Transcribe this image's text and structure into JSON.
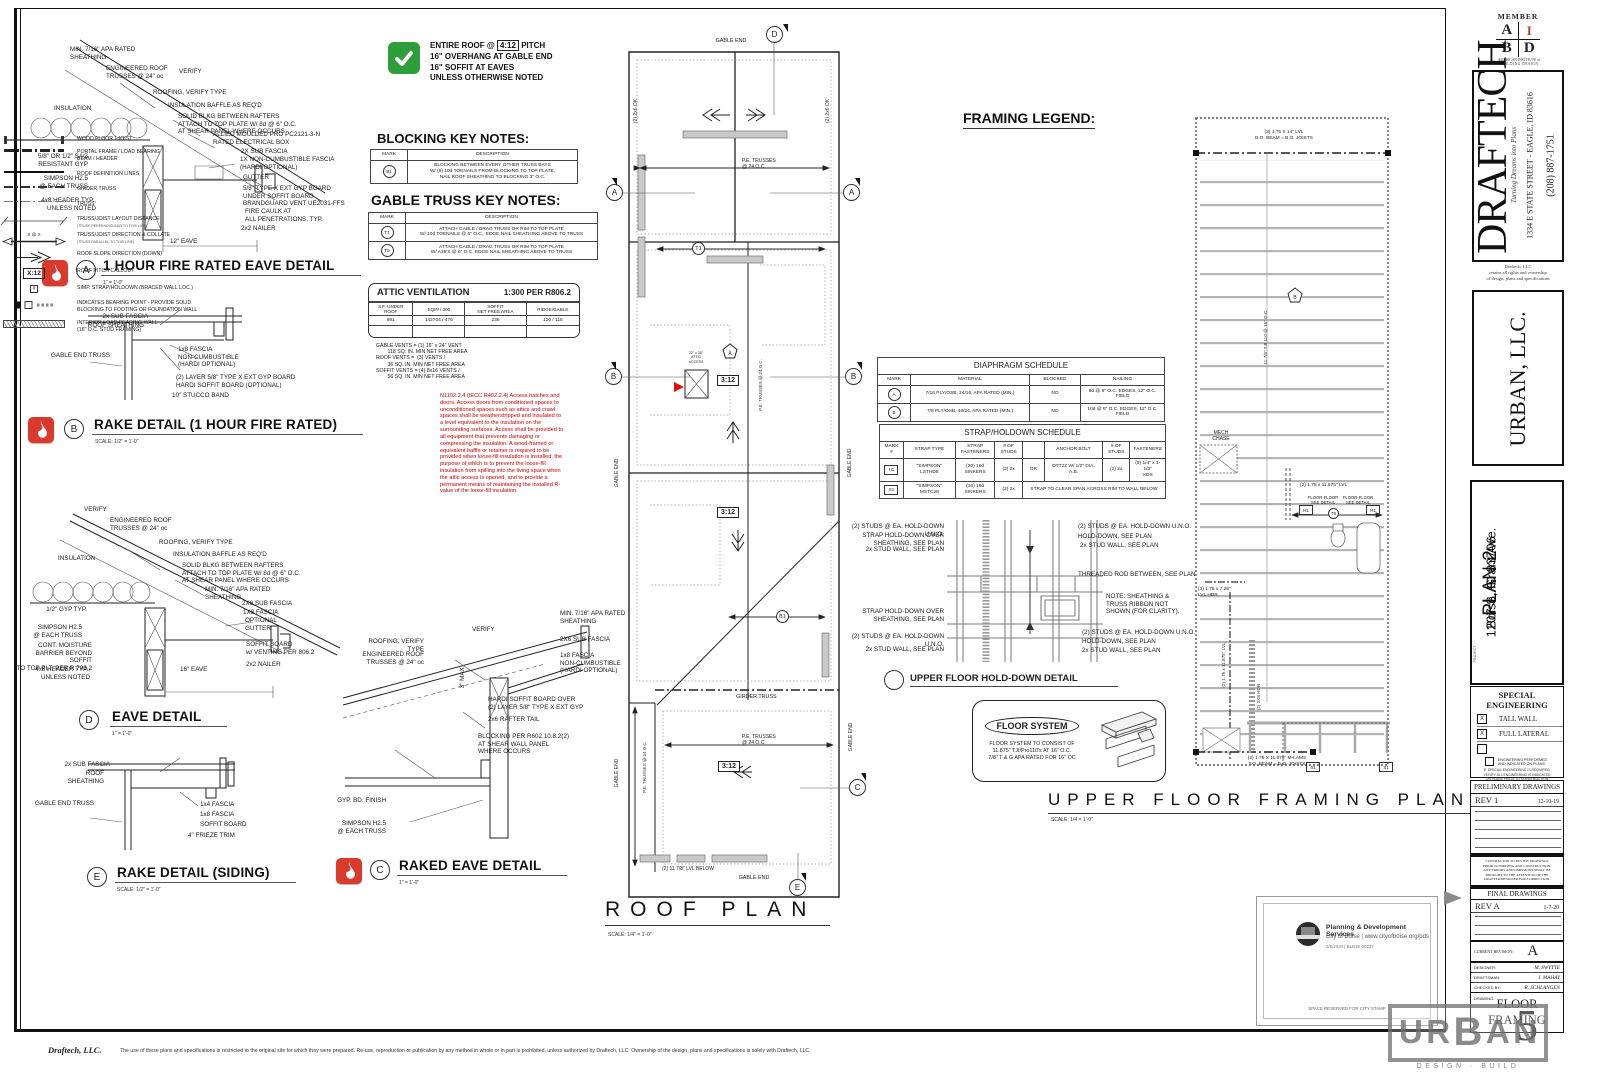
{
  "sheet": {
    "roof_note": {
      "pre": "ENTIRE ROOF @",
      "pitch": "4:12",
      "post": "PITCH",
      "line2": "16\" OVERHANG AT GABLE END",
      "line3": "16\" SOFFIT AT EAVES",
      "line4": "UNLESS OTHERWISE NOTED"
    },
    "footer_firm": "Draftech, LLC.",
    "footer_text": "The use of these plans and specifications is restricted to the original site for which they were prepared. Re-use, reproduction or publication by any method in whole or in part is prohibited, unless authorized by Draftech, LLC. Ownership of the design, plans and specifications is solely with Draftech, LLC."
  },
  "details": {
    "a": {
      "mark": "A",
      "title": "1 HOUR FIRE RATED EAVE DETAIL",
      "scale": "1\" = 1'-0\"",
      "labels": [
        "MIN. 7/16\" APA RATED\nSHEATHING",
        "ENGINEERED ROOF\nTRUSSES @ 24\" oc",
        "VERIFY",
        "ROOFING, VERIFY TYPE",
        "INSULATION BAFFLE AS REQ'D",
        "SOLID BLKG BETWEEN RAFTERS\nATTACH TO TOP PLATE W/ 8d @ 6\" O.C.\nAT SHEAR PANEL WHERE OCCURS",
        "INSULATION",
        "ALLIED MOULDED PRO PC2121-3-N\nRATED ELECTRICAL BOX",
        "2X SUB FASCIA",
        "1X NON-CUMBUSTIBLE FASCIA\n(HARDI OPTIONAL)",
        "GUTTER",
        "5/8\" OR 1/2\" SAG\nRESISTANT GYP",
        "SIMPSON H2.5\n@ EACH TRUSS",
        "5/8\" TYPE X EXT GYP BOARD\nUNDER SOFFIT BOARD\nBRANDGUARD VENT UE2031-FFS",
        "4x8 HEADER TYP.,\nUNLESS NOTED",
        "FIRE CAULK AT\nALL PENETRATIONS, TYP.",
        "12\" EAVE",
        "2x2 NAILER"
      ]
    },
    "b": {
      "mark": "B",
      "title": "RAKE DETAIL (1 HOUR FIRE RATED)",
      "scale": "SCALE: 1/2\" = 1'-0\"",
      "labels": [
        "2x SUB FASCIA",
        "ROOF SHEATHING",
        "GABLE END TRUSS",
        "1x8 FASCIA\nNON-CUMBUSTIBLE\n(HARDI OPTIONAL)",
        "(2) LAYER 5/8\" TYPE X EXT GYP BOARD\nHARDI SOFFIT BOARD (OPTIONAL)",
        "10\" STUCCO BAND"
      ]
    },
    "c": {
      "mark": "C",
      "title": "RAKED EAVE DETAIL",
      "scale": "1\" = 1'-0\"",
      "labels": [
        "MIN. 7/16\" APA RATED\nSHEATHING",
        "VERIFY",
        "ROOFING, VERIFY TYPE",
        "ENGINEERED ROOF\nTRUSSES @ 24\" oc",
        "2X6 SUB FASCIA",
        "1x8 FASCIA\nNON-CUMBUSTIBLE\n(HARDI OPTIONAL)",
        "HARDI SOFFIT BOARD OVER\n(2) LAYER 5/8\" TYPE X EXT GYP",
        "2x6 RAFTER TAIL",
        "BLOCKING PER R602.10.8.2(2)\nAT SHEAR WALL PANEL\nWHERE OCCURS",
        "GYP. BD. FINISH",
        "SIMPSON H2.5\n@ EACH TRUSS",
        "3\" MAX"
      ]
    },
    "d": {
      "mark": "D",
      "title": "EAVE DETAIL",
      "scale": "1\" = 1'-0\"",
      "labels": [
        "VERIFY",
        "ENGINEERED ROOF\nTRUSSES @ 24\" oc",
        "ROOFING, VERIFY TYPE",
        "INSULATION BAFFLE AS REQ'D",
        "SOLID BLKG BETWEEN RAFTERS\nATTACH TO TOP PLATE W/ 8d @ 6\" O.C.\nAT SHEAR PANEL WHERE OCCURS",
        "INSULATION",
        "MIN. 7/16\" APA RATED\nSHEATHING",
        "2X6 SUB FASCIA",
        "1X8 FASCIA",
        "OPTIONAL\nGUTTER",
        "1/2\" GYP TYP.",
        "SIMPSON H2.5\n@ EACH TRUSS",
        "CONT. MOISTURE\nBARRIER BEYOND SOFFIT\nTO TOP PLT. PER R 703.2",
        "4x8 HEADER TYP.,\nUNLESS NOTED",
        "SOFFIT BOARD\nw/ VENTING PER 806.2",
        "2x2 NAILER",
        "16\" EAVE"
      ]
    },
    "e": {
      "mark": "E",
      "title": "RAKE DETAIL (SIDING)",
      "scale": "SCALE: 1/2\" = 1'-0\"",
      "labels": [
        "2x SUB FASCIA",
        "ROOF SHEATHING",
        "GABLE END TRUSS",
        "1x4 FASCIA",
        "1x8 FASCIA",
        "SOFFIT BOARD",
        "4\" FRIEZE TRIM"
      ]
    }
  },
  "blocking_notes": {
    "title": "BLOCKING KEY NOTES:",
    "headers": [
      "MARK",
      "DESCRIPTION"
    ],
    "rows": [
      {
        "mark": "B1",
        "desc": "BLOCKING BETWEEN EVERY OTHER TRUSS BAYS\nW/ (6) 10d TOENAILS FROM BLOCKING TO TOP PLATE,\nNAIL ROOF SHEATHING TO BLOCKING 3\" O.C."
      }
    ]
  },
  "gable_notes": {
    "title": "GABLE TRUSS KEY NOTES:",
    "headers": [
      "MARK",
      "DESCRIPTION"
    ],
    "rows": [
      {
        "mark": "T1",
        "desc": "ATTACH GABLE / DRAG TRUSS OR RIM TO TOP PLATE\nW/ 10d TOENAILS @ 6\" O.C., EDGE NAIL SHEATHING ABOVE TO TRUSS"
      },
      {
        "mark": "T5",
        "desc": "ATTACH GABLE / DRAG TRUSS OR RIM TO TOP PLATE\nW/ A35'S @ 6\" O.C. EDGE NAIL SHEATHING ABOVE TO TRUSS"
      }
    ]
  },
  "attic_vent": {
    "title": "ATTIC VENTILATION",
    "ratio": "1:300 PER R806.2",
    "headers": [
      "S.F. UNDER\nROOF",
      "SQIN / 300",
      "SOFFIT\nNET FREE AREA",
      "RIDGE/GABLE"
    ],
    "row": [
      "991",
      "142704 / 476",
      "236",
      "120 / 118"
    ],
    "notes": "GABLE VENTS = (1) 16\" x 24\" VENT\n        118 SQ. IN. MIN NET FREE AREA\nROOF VENTS =  (3) VENTS /\n        36 SQ. IN. MIN NET FREE AREA\nSOFFIT VENTS = (4) 8x16 VENTS /\n        56 SQ. IN. MIN NET FREE AREA"
  },
  "code_note": "N1102.2.4 (IECC R402.2.4) Access hatches and doors. Access doors from conditioned spaces to unconditioned spaces such as attics and crawl spaces shall be weatherstripped and insulated to a level equivalent to the insulation on the surrounding surfaces. Access shall be provided to all equipment that prevents damaging or compressing the insulation. A wood-framed or equivalent baffle or retainer is required to be provided when loose-fill insulation is installed, the purpose of which is to prevent the loose-fill insulation from spilling into the living space when the attic access is opened, and to provide a permanent means of maintaining the installed R-value of the loose-fill insulation.",
  "framing_legend": {
    "title": "FRAMING LEGEND:",
    "collate_sym": "X @ X",
    "pitch_sym": "X:12",
    "hash_sym": "#",
    "items": [
      {
        "label": "WOOD FLOOR I-JOIST"
      },
      {
        "label": "PORTAL FRAME / LOAD BEARING\nBEAM / HEADER"
      },
      {
        "label": "ROOF DEFINITION LINES"
      },
      {
        "label": "GIRDER TRUSS"
      },
      {
        "label": "TRUSS"
      },
      {
        "label": "TRUSS/JOIST LAYOUT DISTANCE",
        "sub": "(TRUSS PERPENDICULAR TO THIS LINE)"
      },
      {
        "label": "TRUSS/JOIST DIRECTION & COLLATE",
        "sub": "(TRUSS PARALLEL TO THIS LINE)"
      },
      {
        "label": "ROOF SLOPE DIRECTION (DOWN)"
      },
      {
        "label": "ROOF PITCH CALLOUT"
      },
      {
        "label": "SIMP. STRAP/HOLDOWN (BRACED WALL LOC.)"
      },
      {
        "label": "INDICATES BEARING POINT - PROVIDE SOLID\nBLOCKING TO FOOTING OR FOUNDATION WALL"
      },
      {
        "label": "INTERIOR LOAD BEARING WALL\n(16\" O.C. STUD FRAMING)"
      }
    ]
  },
  "diaphragm": {
    "title": "DIAPHRAGM SCHEDULE",
    "headers": [
      "MARK",
      "MATERIAL",
      "BLOCKED",
      "NAILING"
    ],
    "rows": [
      [
        "A",
        "7/16 PLY/OSB, 24/16, APA RATED (MIN.)",
        "NO",
        "8d @  6\" O.C. EDGES, 12\" O.C. FIELD"
      ],
      [
        "B",
        "7/8 PLY/OSB, 48/24, APA RATED (MIN.)",
        "NO",
        "10d @ 6\" O.C. EDGES, 12\" O.C. FIELD"
      ]
    ]
  },
  "strap": {
    "title": "STRAP/HOLDOWN SCHEDULE",
    "headers": [
      "MARK\n#",
      "STRAP TYPE",
      "STRAP\nFASTENERS",
      "# OF\nSTUDS",
      "",
      "ANCHOR BOLT",
      "# OF\nSTUDS",
      "FASTENERS"
    ],
    "row1": [
      "H1",
      "\"SIMPSON\" LSTHD8",
      "(20) 16d\nSINKERS",
      "(2) 2x",
      "OR",
      "DTT2Z W/ 1/2\" DIA. A.B.",
      "(2) 2x",
      "(8) 1/4\" x 1-1/2\"\nSDS"
    ],
    "row2": [
      "S1",
      "\"SIMPSON\" MSTC28",
      "(16) 16d\nSINKERS",
      "(2) 2x",
      "STRAP TO CLEAR SPAN ACROSS RIM TO WALL BELOW"
    ]
  },
  "roof_plan": {
    "title": "ROOF PLAN",
    "scale": "SCALE: 1/4\" = 1'-0\"",
    "gable_end": "GABLE END",
    "pe": "P.E. TRUSSES\n@ 24 O.C.",
    "pe_inline": "P.E. TRUSSES @ 24 O.C.",
    "pitch": "3:12",
    "girder": "GIRDER TRUSS",
    "lvl_below": "(2) 11 7/8\" LVL BELOW",
    "ok": "(2) 2x6 OK",
    "attic": "22\" x 30\"\nATTIC\nACCESS",
    "m_a": "A",
    "m_b": "B",
    "m_c": "C",
    "m_d": "D",
    "m_e": "E",
    "t1": "T1",
    "b1": "B1",
    "pent_a": "A"
  },
  "holddown": {
    "title": "UPPER FLOOR HOLD-DOWN DETAIL",
    "left": [
      "(2) STUDS @ EA. HOLD-DOWN U.N.O.",
      "STRAP HOLD-DOWN OVER\nSHEATHING, SEE PLAN",
      "2x STUD WALL, SEE PLAN",
      "STRAP HOLD-DOWN OVER\nSHEATHING, SEE PLAN",
      "(2) STUDS @ EA. HOLD-DOWN U.N.O.",
      "2x STUD WALL, SEE PLAN"
    ],
    "right": [
      "(2) STUDS @ EA. HOLD-DOWN U.N.O.",
      "HOLD-DOWN, SEE PLAN",
      "2x STUD WALL, SEE PLAN",
      "THREADED ROD BETWEEN, SEE PLAN",
      "NOTE: SHEATHING &\nTRUSS RIBBON NOT\nSHOWN (FOR CLARITY).",
      "(2) STUDS @ EA. HOLD-DOWN U.N.O.",
      "HOLD-DOWN, SEE PLAN",
      "2x STUD WALL, SEE PLAN"
    ]
  },
  "floor_system": {
    "title": "FLOOR SYSTEM",
    "body": "FLOOR SYSTEM TO CONSIST OF\n11.875\" TJI/Pro110's  AT 16\" O.C.\n7/8\" T & G APA RATED FOR 16\" OC"
  },
  "upper_plan": {
    "title": "UPPER FLOOR FRAMING PLAN",
    "scale": "SCALE: 1/4 = 1'-0\"",
    "lvl_top": "(3) 1.75 X 14\" LVL\nB.O. BEAM = B.O. JOISTS",
    "tji": "11 7/8\" TJI 110 @ 16\" O.C.",
    "pent": "B",
    "mech": "MECH\nCHASE",
    "lvl_mid": "(2) 1.75 x 11.875\" LVL",
    "ff": "FLOOR-FLOOR\nSEE DETAIL",
    "h1": "H1",
    "t5": "T5",
    "lvl_hdr": "(3) 1.75 x 7.25\"\nLVL HDR",
    "lvl_left": "(2) 1.75 x 11.875\" LVL",
    "hdr_2x8": "(2) 2X8 HDR",
    "mlams": "(2) 1.75 X 11.875\" M-LAMS\nT.O. BEAM = B.O. JOISTS",
    "s1": "S1"
  },
  "stamp": {
    "line1": "Planning & Development Services",
    "line2": "City of Boise | www.cityofboise.org/pds",
    "line3": "3/5/2020 | BLD20-00237",
    "reserved": "SPACE RESERVED FOR CITY STAMP"
  },
  "titleblock": {
    "member": "MEMBER",
    "aibd_a": "A",
    "aibd_i": "I",
    "aibd_b": "B",
    "aibd_d": "D",
    "aibd_sub1": "AMERICAN INSTITUTE of",
    "aibd_sub2": "BUILDING DESIGN",
    "firm": "DRAFTECH",
    "tagline": "Turning Dreams into Plans",
    "address": "1334 E STATE STREET - EAGLE, ID 83616",
    "phone": "(208) 887-1751",
    "rights": "Draftech, LLC\nretains all rights and ownership\nof design, plans and specifications",
    "client": "URBAN, LLC.",
    "project_label": "PROJECT",
    "plan_name": "PLAN 2",
    "plan_addr1": "1207 S. Grant Ave.",
    "plan_addr2": "Boise, ID 83706",
    "special_title": "SPECIAL\nENGINEERING",
    "check_mark": "X",
    "opt_tall": "TALL WALL",
    "opt_lateral": "FULL LATERAL",
    "eng_note": "ENGINEERING PERFORMED\nAND INDICATED ON PLANS",
    "special_warn": "IF SPECIAL ENGINEERING IS REQUIRED,\nVERIFY ALL ENGINEERING IS INDICATED\nON PLANS PRIOR TO CONSTRUCTION",
    "prelim_title": "PRELIMINARY DRAWINGS",
    "prelim_rev": "REV 1",
    "prelim_date": "12-10-19",
    "contractor_note": "CONTRACTOR TO REVIEW DRAWINGS\nPRIOR TO BIDDING AND CONSTRUCTION.\nANY ERRORS AND OMISSIONS SHALL BE\nBROUGHT TO THE ATTENTION OF THE\nDRAFTER/DESIGNER FOR CORRECTION.",
    "final_title": "FINAL DRAWINGS",
    "final_rev": "REV A",
    "final_date": "1-7-20",
    "current_label": "CURRENT REVISION:",
    "current_rev": "A",
    "designer_label": "DESIGNER:",
    "designer": "M. SWYTTE",
    "draftsman_label": "DRAFTSMAN:",
    "draftsman": "J. MAHAY",
    "checked_label": "CHECKED BY:",
    "checked": "R. SCHLANGEN",
    "drawing_label": "DRAWING:",
    "drawing": "FLOOR\nFRAMING",
    "sheet_no": "5"
  },
  "urban_logo": {
    "u": "U",
    "r": "R",
    "b": "B",
    "a": "A",
    "n": "N",
    "sub": "DESIGN · BUILD"
  }
}
